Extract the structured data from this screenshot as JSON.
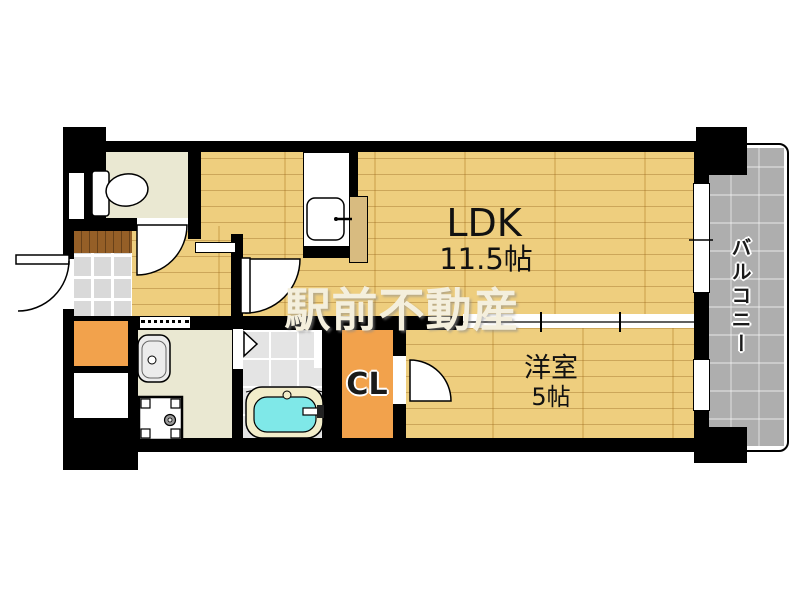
{
  "floorplan": {
    "watermark": "駅前不動産",
    "rooms": {
      "ldk": {
        "name": "LDK",
        "size": "11.5帖"
      },
      "western": {
        "name": "洋室",
        "size": "5帖"
      },
      "closet": {
        "name": "CL"
      },
      "balcony": {
        "name": "バルコニー"
      }
    },
    "fixtures": [
      "toilet",
      "kitchen-sink",
      "washbasin",
      "washing-machine-pan",
      "bathtub"
    ],
    "colors": {
      "wall": "#000000",
      "flooring_wood": "#edca74",
      "room_cream": "#eae8d2",
      "closet_floor_orange": "#f2a24c",
      "bath_water_cyan": "#7fe8e8",
      "balcony_deck_gray": "#aeaeae",
      "entrance_tile_gray": "#d9d9d9",
      "step_brown": "#955f27",
      "watermark_text": "#f4efdd"
    }
  }
}
